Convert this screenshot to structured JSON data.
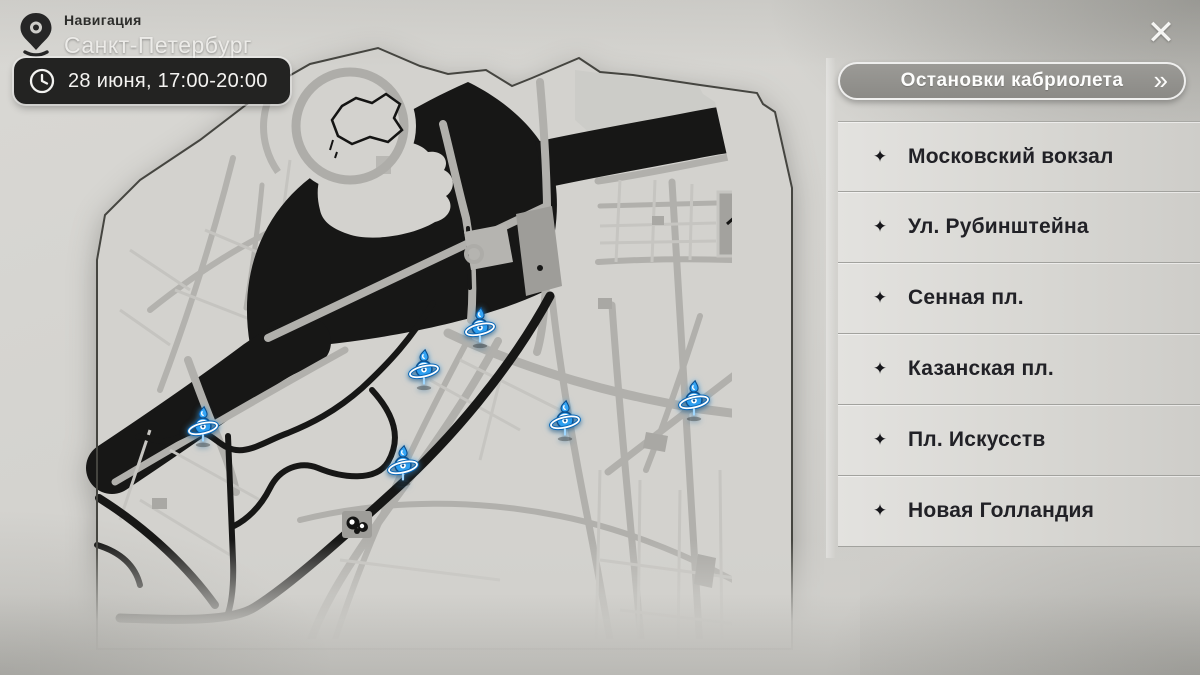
{
  "window": {
    "close_icon": "✕"
  },
  "nav": {
    "label": "Навигация",
    "city": "Санкт-Петербург",
    "schedule": "28 июня, 17:00-20:00"
  },
  "panel": {
    "title": "Остановки кабриолета",
    "chevron_icon": "»",
    "stop_icon": "✦",
    "stops": [
      {
        "label": "Московский вокзал"
      },
      {
        "label": "Ул. Рубинштейна"
      },
      {
        "label": "Сенная пл."
      },
      {
        "label": "Казанская пл."
      },
      {
        "label": "Пл. Искусств"
      },
      {
        "label": "Новая Голландия"
      }
    ]
  },
  "map": {
    "city": "Санкт-Петербург",
    "markers": [
      {
        "stop": "Пл. Искусств",
        "x": 480,
        "y": 331
      },
      {
        "stop": "Казанская пл.",
        "x": 424,
        "y": 373
      },
      {
        "stop": "Новая Голландия",
        "x": 203,
        "y": 430
      },
      {
        "stop": "Сенная пл.",
        "x": 403,
        "y": 469
      },
      {
        "stop": "Ул. Рубинштейна",
        "x": 565,
        "y": 424
      },
      {
        "stop": "Московский вокзал",
        "x": 694,
        "y": 404
      }
    ]
  },
  "colors": {
    "marker_blue": "#2d9ff0",
    "river_black": "#171716",
    "badge_bg": "#232322",
    "land": "#d3d2ce"
  }
}
